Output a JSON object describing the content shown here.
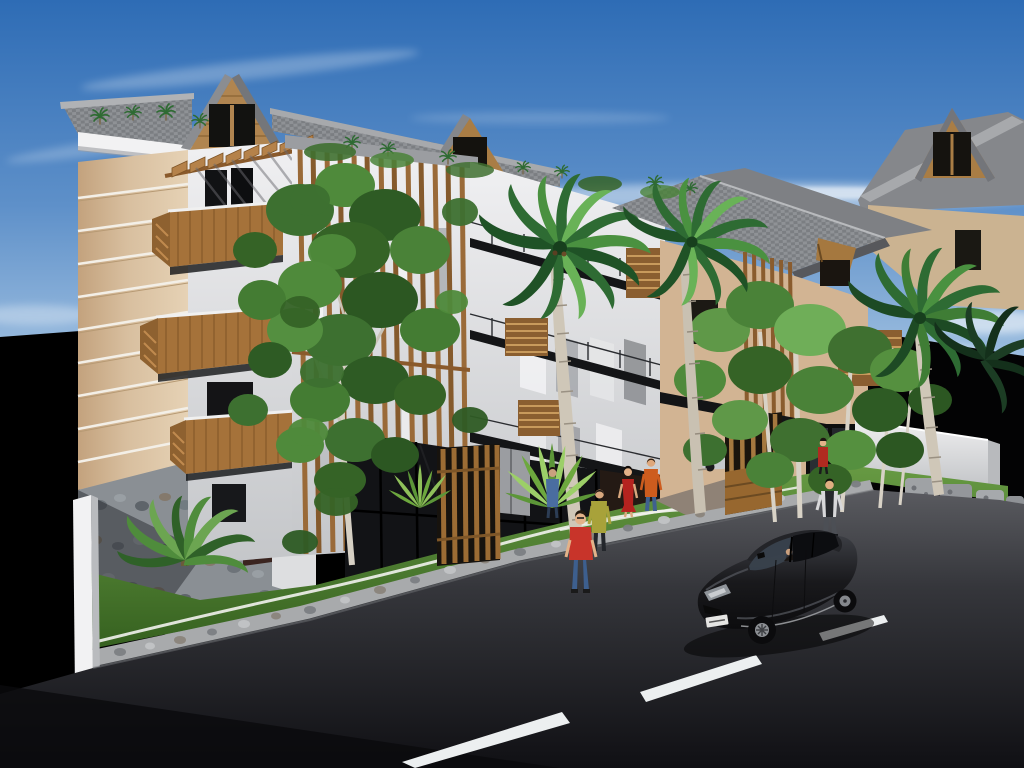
{
  "scene": {
    "type": "3d-architectural-rendering",
    "subject": "modern tropical apartment building street view",
    "time_of_day": "day, strong sun from left",
    "counts": {
      "dormer_windows": 3,
      "wood_balconies": 3,
      "tall_palms": 3,
      "dark_palms": 1,
      "pedestrians": 7,
      "cars": 2,
      "lane_dashes": 3,
      "agave_plants": 2
    }
  },
  "palette": {
    "sky_top": "#2E6CB5",
    "sky_mid": "#5E90C9",
    "sky_low": "#A9C7E4",
    "sky_horizon": "#DCE9F4",
    "cloud": "#FFFFFF",
    "facade_tan": "#D8BF9F",
    "facade_tan_dark": "#C3A27D",
    "facade_white": "#ECECEE",
    "facade_gray": "#C4C6C9",
    "roof_gray": "#8F9296",
    "roof_dark": "#6F7276",
    "wood": "#A5723A",
    "wood_dark": "#7E5426",
    "wood_light": "#C08A4E",
    "window_dark": "#121316",
    "glass_tint": "#39434E",
    "stone_wall": "#8A8F94",
    "curb_stone": "#A8AAAC",
    "boundary_wall": "#EFEFF0",
    "white_post": "#F2F2F3",
    "paving": "#8F8276",
    "door_brown": "#3A2420",
    "grass": "#4C7F31",
    "grass_dark": "#35601F",
    "grass_light": "#679A43",
    "foliage_dark": "#2E5B28",
    "foliage_mid": "#4A8238",
    "foliage_light": "#6FAD56",
    "palm_green": "#2E6B33",
    "road_light": "#5A5B60",
    "road_mid": "#35363B",
    "road_dark": "#101014",
    "marking": "#ECEFF0",
    "night_black": "#030304",
    "car_black": "#19191C",
    "car_silver": "#C6C9CD",
    "skin": "#E3B289",
    "shirt_red": "#C8342A",
    "shirt_olive": "#A8A23A",
    "dress_red": "#B5231F",
    "shirt_orange": "#CD5C1E",
    "jacket_blue": "#4A6DA0",
    "jeans_blue": "#3D5F8E",
    "vest_dark": "#26282C"
  },
  "pedestrians": [
    {
      "id": "red-shirt-jeans",
      "top_color": "#C8342A",
      "bottom_color": "#3D5F8E",
      "location": "road edge, foreground left of car"
    },
    {
      "id": "olive-top",
      "top_color": "#A8A23A",
      "bottom_color": "#23262B",
      "location": "lawn walkway, facing building"
    },
    {
      "id": "red-dress",
      "top_color": "#B5231F",
      "bottom_color": "#B5231F",
      "location": "entry walkway"
    },
    {
      "id": "orange-shirt",
      "top_color": "#CD5C1E",
      "bottom_color": "#3F618F",
      "location": "entry walkway, facing building"
    },
    {
      "id": "blue-jacket",
      "top_color": "#4A6DA0",
      "bottom_color": "#2C3D55",
      "location": "near storefront glazing"
    },
    {
      "id": "dark-vest",
      "top_color": "#26282C",
      "bottom_color": "#4C4F55",
      "location": "road edge, right of scene"
    },
    {
      "id": "red-small",
      "top_color": "#B02A20",
      "bottom_color": "#1A1A1C",
      "location": "right wing glass door"
    }
  ],
  "vehicles": [
    {
      "id": "black-hatchback",
      "color": "#19191C",
      "state": "driving on road, facing lower-left",
      "plate_color": "#E5E5E3"
    },
    {
      "id": "silver-parked-car",
      "color": "#C6C9CD",
      "state": "parked in driveway behind wood trellis"
    }
  ]
}
